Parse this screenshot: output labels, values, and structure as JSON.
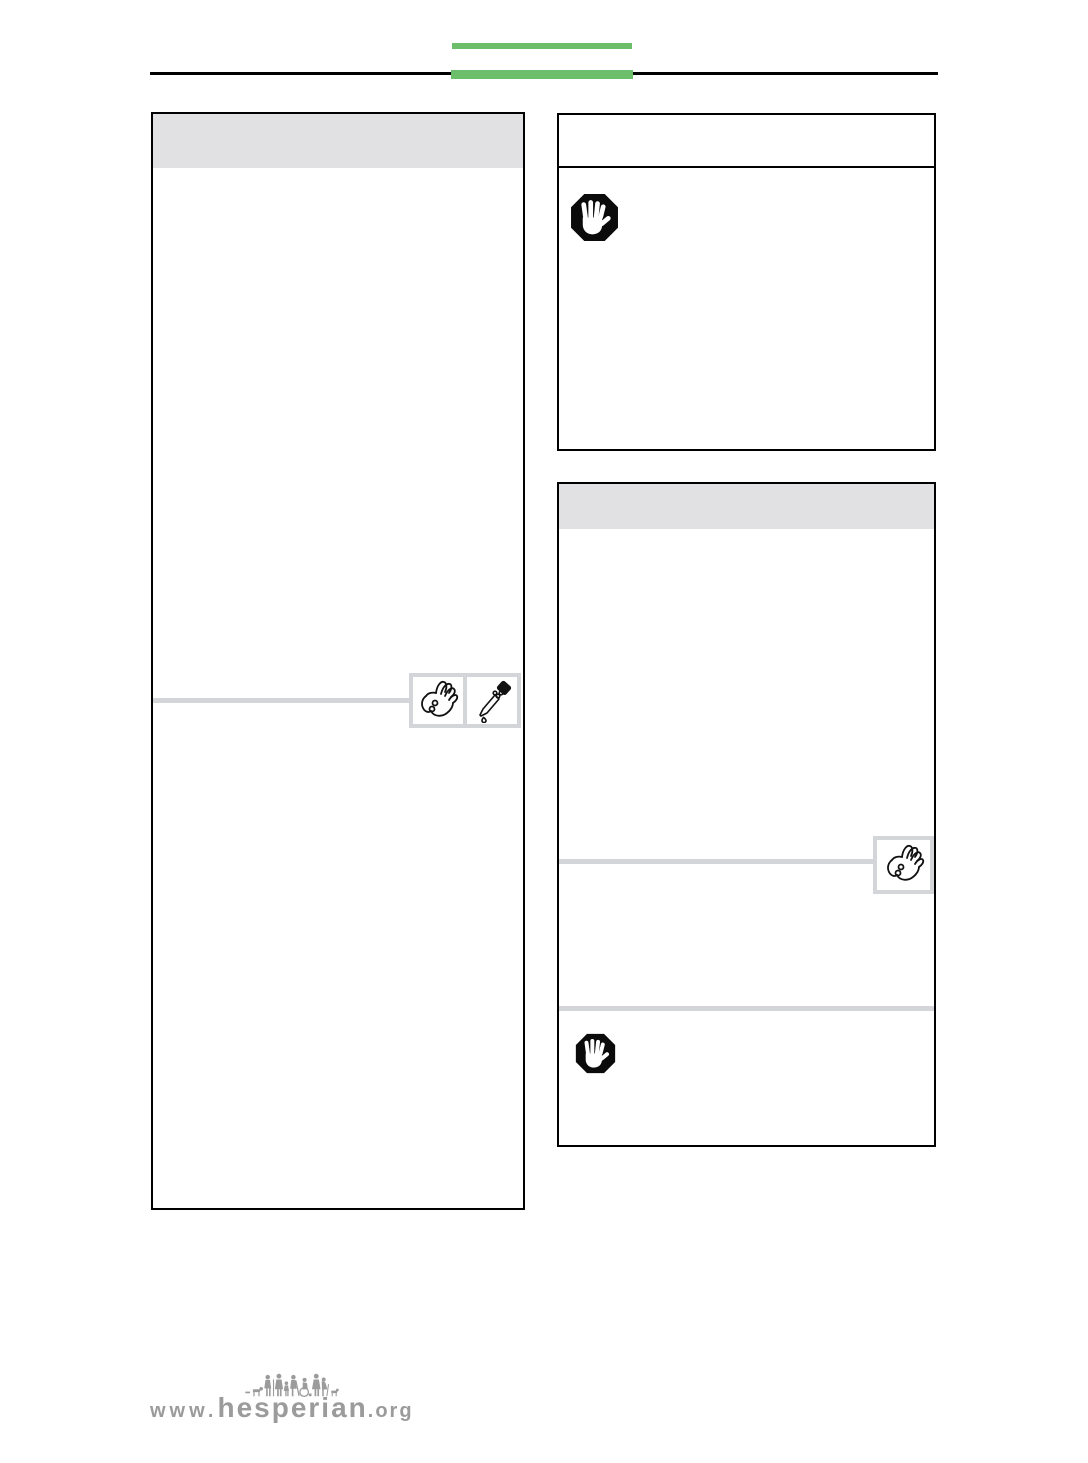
{
  "theme": {
    "accent_green": "#6cbe6a",
    "panel_header_gray": "#e1e1e4",
    "divider_gray": "#d4d5d8",
    "border_black": "#000000",
    "logo_gray": "#9b9b9b"
  },
  "panels": {
    "left": {
      "icons": [
        {
          "name": "hand-with-pills-icon",
          "label": "hand holding pills"
        },
        {
          "name": "dropper-icon",
          "label": "medicine dropper"
        }
      ]
    },
    "right_top": {
      "icons": [
        {
          "name": "stop-hand-icon",
          "label": "stop warning hand"
        }
      ]
    },
    "right_bottom": {
      "icons": [
        {
          "name": "hand-with-pills-icon",
          "label": "hand holding pills"
        },
        {
          "name": "stop-hand-icon",
          "label": "stop warning hand"
        }
      ]
    }
  },
  "footer": {
    "logo_prefix": "www.",
    "logo_name": "hesperian",
    "logo_suffix": ".org"
  }
}
